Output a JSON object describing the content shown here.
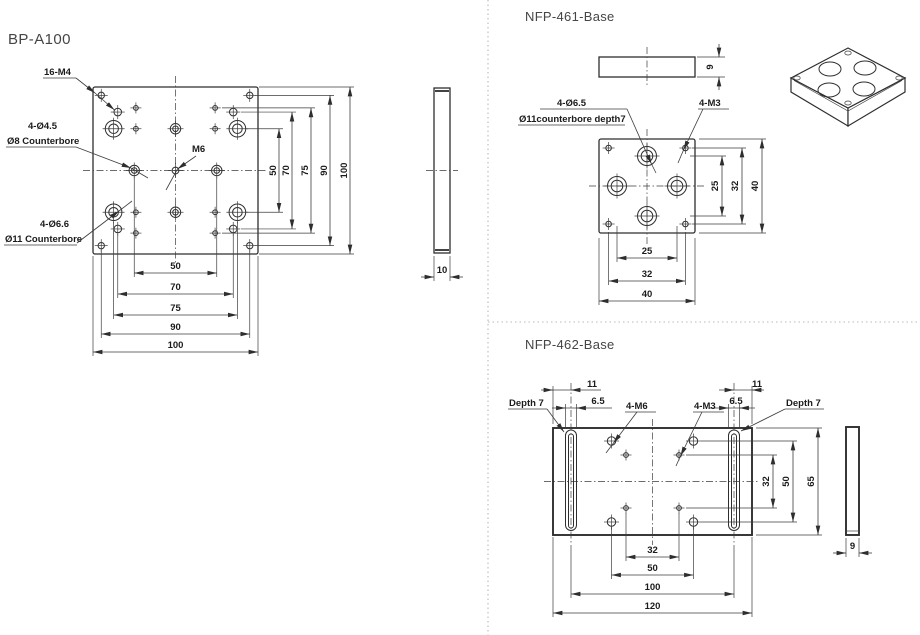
{
  "colors": {
    "line": "#2e2e2e",
    "text": "#1b1b1b",
    "title": "#454545",
    "divider": "#b8b8b8"
  },
  "titles": {
    "bp": "BP-A100",
    "nfp461": "NFP-461-Base",
    "nfp462": "NFP-462-Base"
  },
  "bp_a100": {
    "labels": {
      "m4": "16-M4",
      "cb_small_1": "4-Ø4.5",
      "cb_small_2": "Ø8 Counterbore",
      "m6": "M6",
      "cb_large_1": "4-Ø6.6",
      "cb_large_2": "Ø11 Counterbore"
    },
    "dims_bottom": [
      "50",
      "70",
      "75",
      "90",
      "100"
    ],
    "dims_right": [
      "50",
      "70",
      "75",
      "90",
      "100"
    ],
    "thickness": "10"
  },
  "nfp461": {
    "labels": {
      "cb_1": "4-Ø6.5",
      "cb_2": "Ø11counterbore depth7",
      "m3": "4-M3"
    },
    "dims_bottom": [
      "25",
      "32",
      "40"
    ],
    "dims_right": [
      "25",
      "32",
      "40"
    ],
    "thickness": "9"
  },
  "nfp462": {
    "labels": {
      "depth_left": "Depth 7",
      "depth_right": "Depth 7",
      "m6": "4-M6",
      "m3": "4-M3"
    },
    "dims_top_left": {
      "offset": "11",
      "width": "6.5"
    },
    "dims_top_right": {
      "offset": "11",
      "width": "6.5"
    },
    "dims_bottom": [
      "32",
      "50",
      "100",
      "120"
    ],
    "dims_right": [
      "32",
      "50",
      "65"
    ],
    "thickness": "9"
  }
}
